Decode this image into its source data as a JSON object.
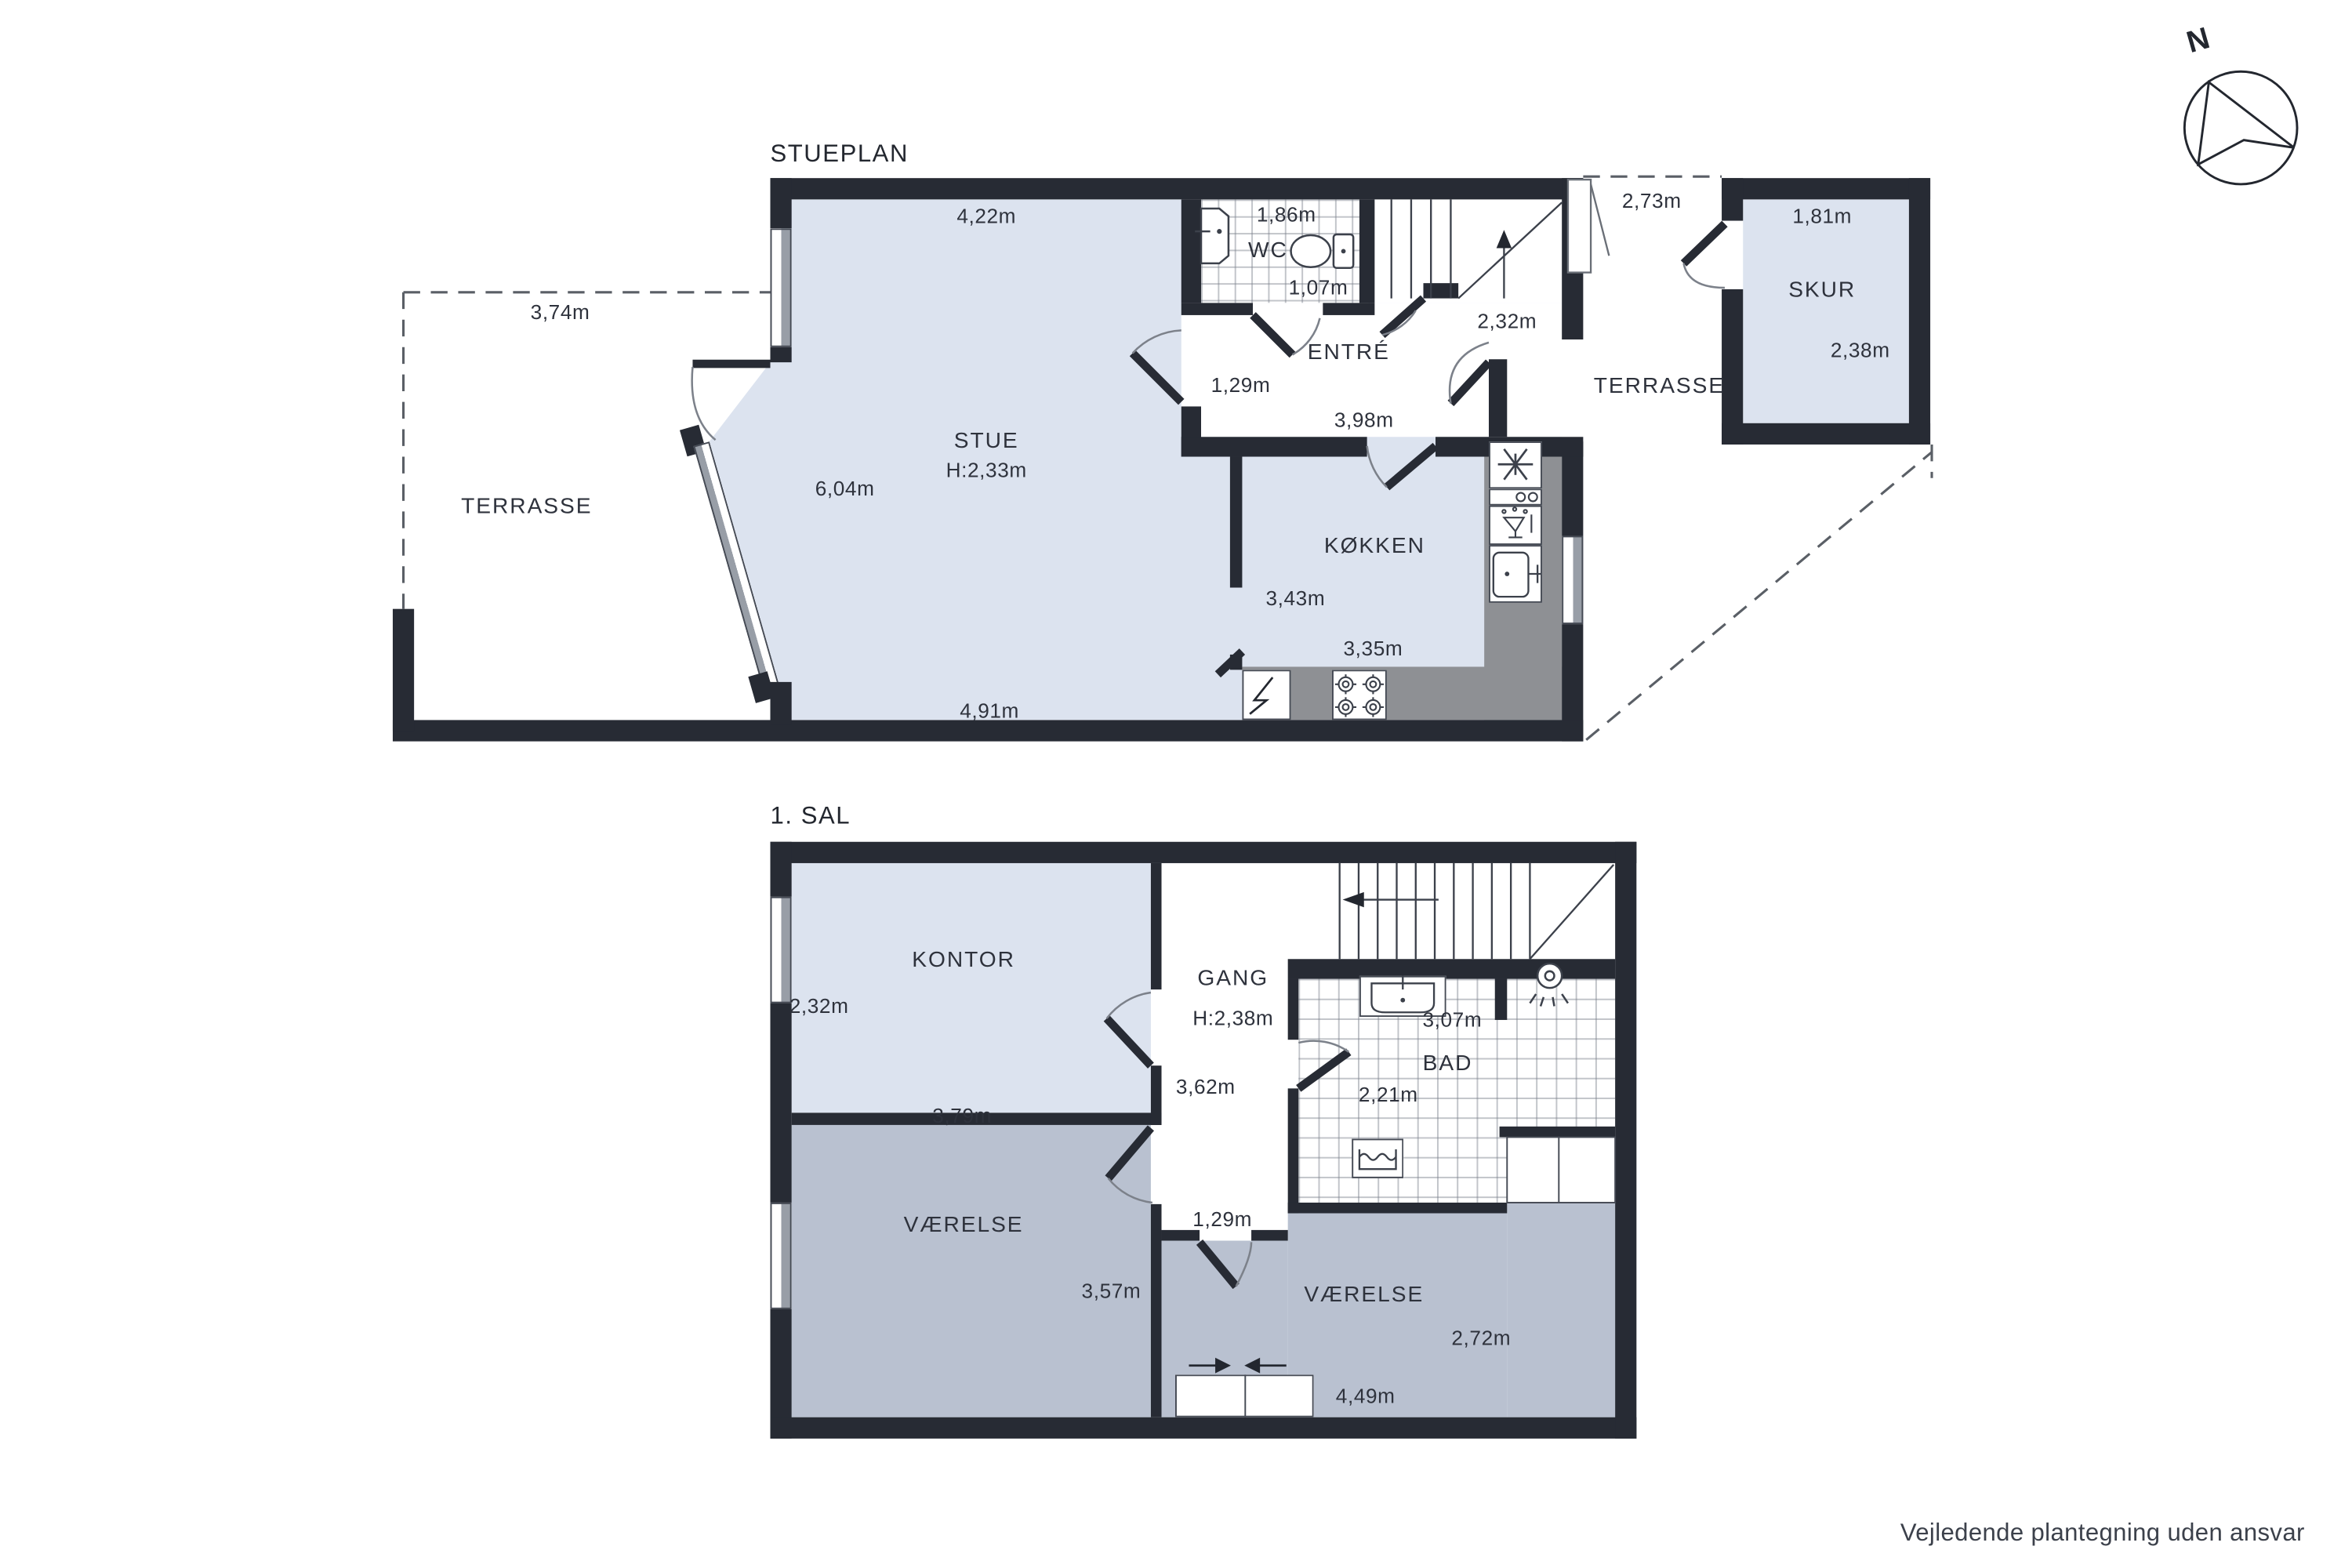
{
  "page": {
    "disclaimer": "Vejledende plantegning uden ansvar"
  },
  "compass": {
    "label": "N"
  },
  "colors": {
    "wall": "#272b34",
    "room_light": "#dce3ef",
    "room_dark": "#b9c1d0",
    "counter": "#8e9094",
    "text": "#2e323c"
  },
  "ground_floor": {
    "title": "STUEPLAN",
    "terrasse_left": {
      "name": "TERRASSE",
      "width": "3,74m"
    },
    "terrasse_right": {
      "name": "TERRASSE",
      "width": "2,73m",
      "door_width": "2,32m"
    },
    "skur": {
      "name": "SKUR",
      "width": "1,81m",
      "depth": "2,38m"
    },
    "stue": {
      "name": "STUE",
      "ceiling": "H:2,33m",
      "top_width": "4,22m",
      "bottom_width": "4,91m",
      "depth": "6,04m"
    },
    "wc": {
      "name": "WC",
      "width": "1,86m",
      "depth": "1,07m"
    },
    "entre": {
      "name": "ENTRÉ",
      "d1": "1,29m",
      "d2": "3,98m"
    },
    "kokken": {
      "name": "KØKKEN",
      "d1": "3,43m",
      "d2": "3,35m"
    }
  },
  "first_floor": {
    "title": "1. SAL",
    "kontor": {
      "name": "KONTOR",
      "depth": "2,32m"
    },
    "gang": {
      "name": "GANG",
      "ceiling": "H:2,38m",
      "d1": "3,62m",
      "door": "1,29m"
    },
    "bad": {
      "name": "BAD",
      "d1": "3,07m",
      "d2": "2,21m"
    },
    "vaerelse_a": {
      "name": "VÆRELSE",
      "d1": "3,79m",
      "d2": "3,57m"
    },
    "vaerelse_b": {
      "name": "VÆRELSE",
      "d1": "2,72m",
      "d2": "4,49m"
    }
  }
}
